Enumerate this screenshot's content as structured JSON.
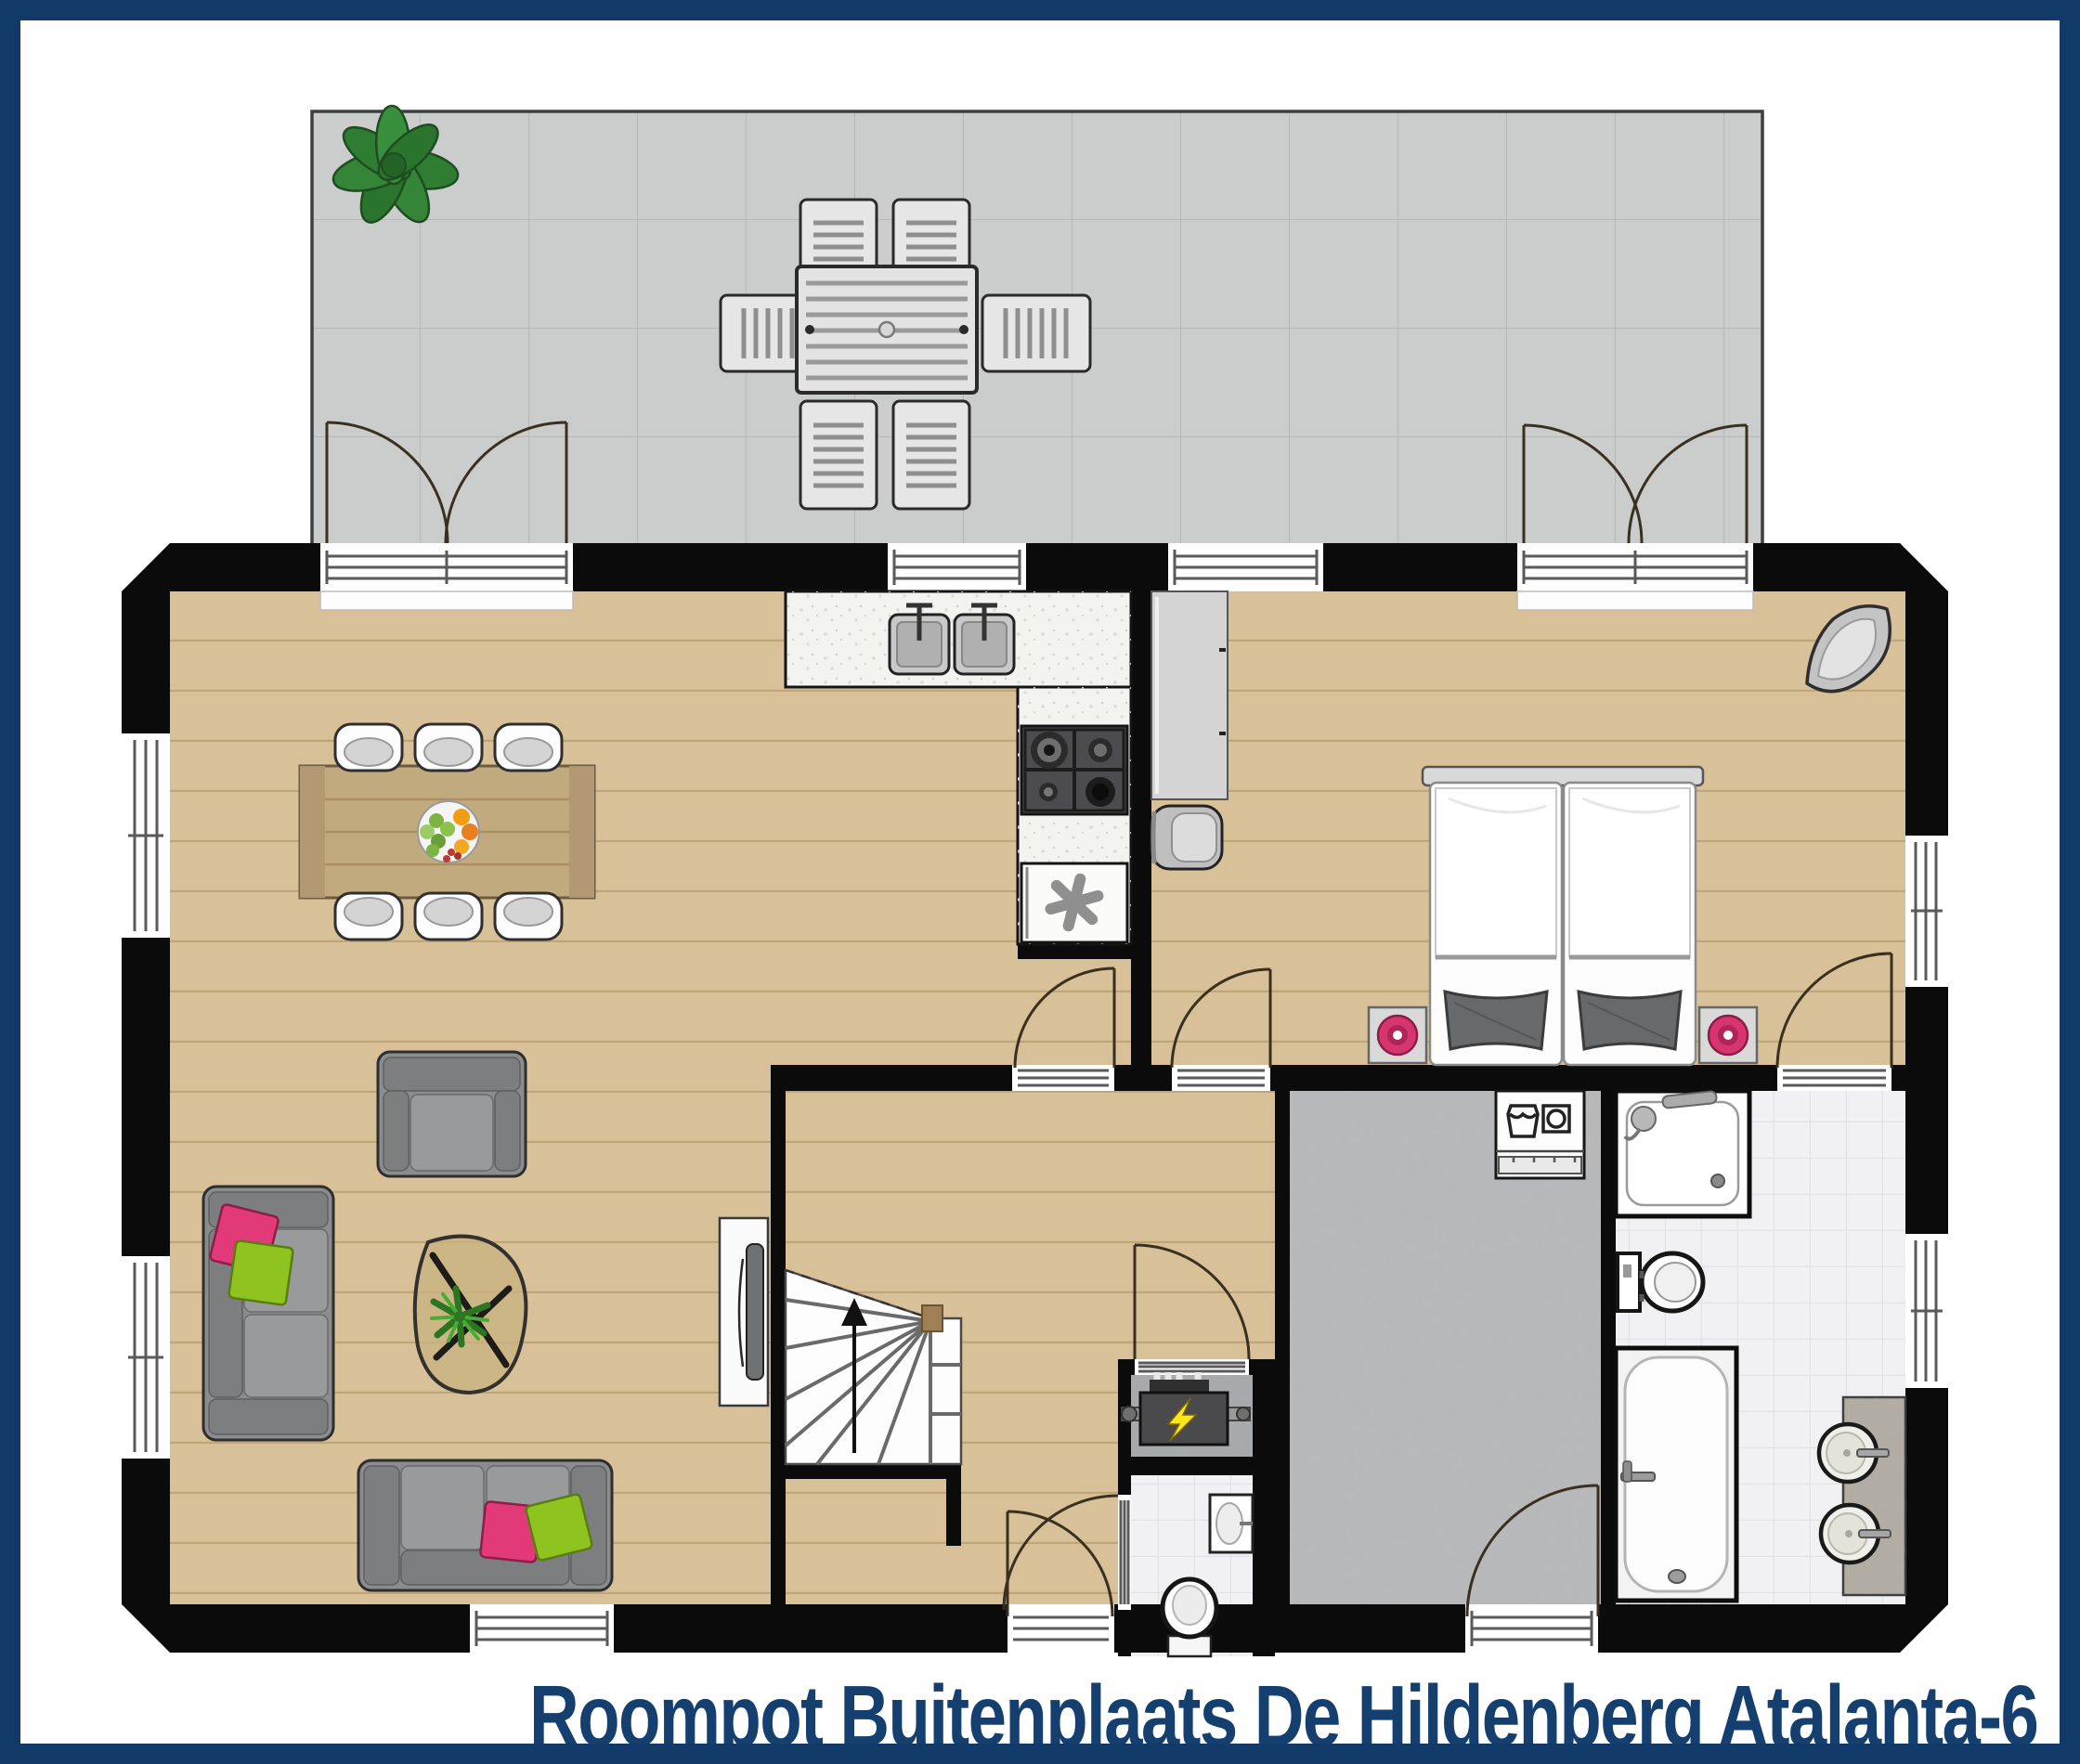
{
  "title": {
    "text": "Roompot Buitenplaats De Hildenberg Atalanta-6"
  },
  "palette": {
    "frame": "#123a68",
    "navy": "#153f6e",
    "wall": "#0b0b0b",
    "wood": "#d8c198",
    "terrace": "#cbcccc",
    "tile": "#f1f1f3",
    "utility": "#b9babc",
    "pink": "#e23a78",
    "green": "#8fc31f"
  },
  "floorplan": {
    "type": "ground-floor plan, top-down view",
    "outdoor": [
      "terrace with tile grid",
      "potted plant",
      "outdoor dining table with six slatted chairs",
      "double french doors to living room",
      "double french doors to bedroom"
    ],
    "living_area": [
      "dining table with fruit bowl and six chairs",
      "armchair",
      "two sofas with pink and green cushions",
      "organic coffee table with plant",
      "tv on sideboard"
    ],
    "kitchen": [
      "l-shaped counter",
      "double sink",
      "gas hob with four burners",
      "freezer with star symbol"
    ],
    "bedroom": [
      "double bed (two singles)",
      "two nightstands with pink lamps",
      "wardrobe cabinet",
      "wall unit",
      "corner unit"
    ],
    "bathroom": [
      "shower",
      "toilet",
      "bathtub",
      "two round basins on counter"
    ],
    "utility_room": [
      "washing machine",
      "entrance door"
    ],
    "technical_closet": [
      "electrical / heater unit with lightning bolt"
    ],
    "toilet_room": [
      "wall basin",
      "toilet"
    ],
    "hall": [
      "winder staircase with up arrow"
    ]
  },
  "icons": {
    "freezer_star": "six-spoke asterisk",
    "power_bolt": "lightning bolt",
    "laundry_wash": "wash tub glyph",
    "laundry_drum": "drum in square glyph",
    "stairs_up_arrow": "arrow pointing up"
  }
}
